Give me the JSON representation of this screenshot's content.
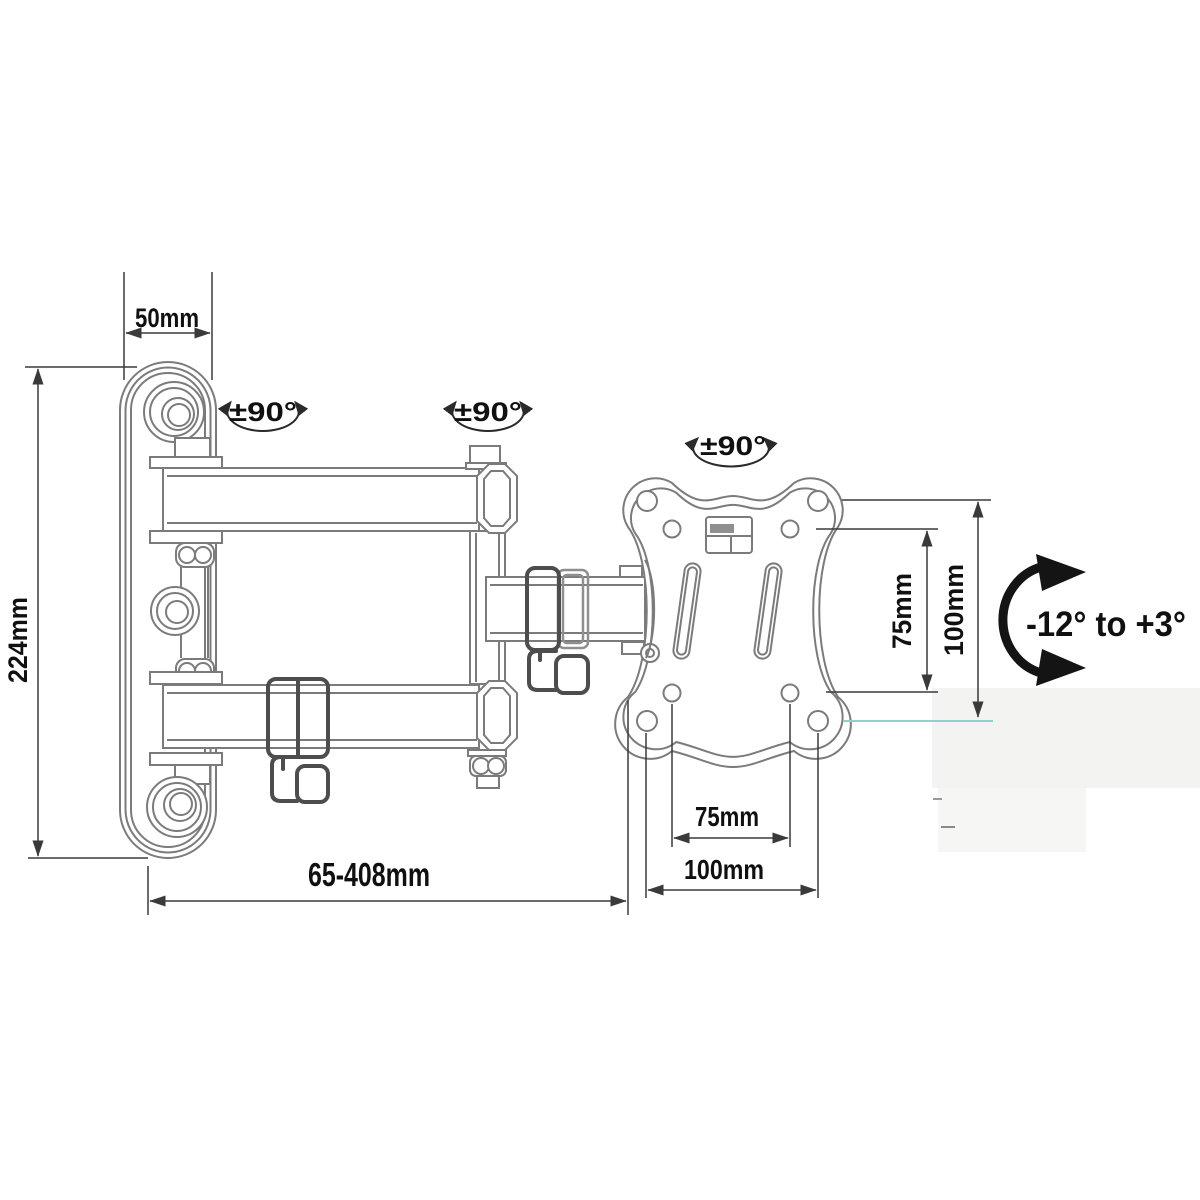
{
  "diagram": {
    "kind": "technical-dimension-drawing",
    "subject": "articulating TV wall mount bracket, side view with VESA plate",
    "colors": {
      "background": "#ffffff",
      "drawing_line": "#7b7b7b",
      "dimension_line": "#3a3a3a",
      "label_text": "#101010",
      "cable_clip_line": "#4d4d4d",
      "collar_line": "#8f8f8f",
      "baseline_teal": "#8fd2c9",
      "shadow_wash": "#f3f3f1"
    },
    "annotations": {
      "plate_width": "50mm",
      "plate_height": "224mm",
      "extension_range": "65-408mm",
      "vesa_width_inner": "75mm",
      "vesa_width_outer": "100mm",
      "vesa_height_inner": "75mm",
      "vesa_height_outer": "100mm",
      "tilt_range": "-12° to +3°",
      "swivel_joint_wall": "±90°",
      "swivel_joint_mid": "±90°",
      "swivel_joint_vesa": "±90°"
    }
  }
}
